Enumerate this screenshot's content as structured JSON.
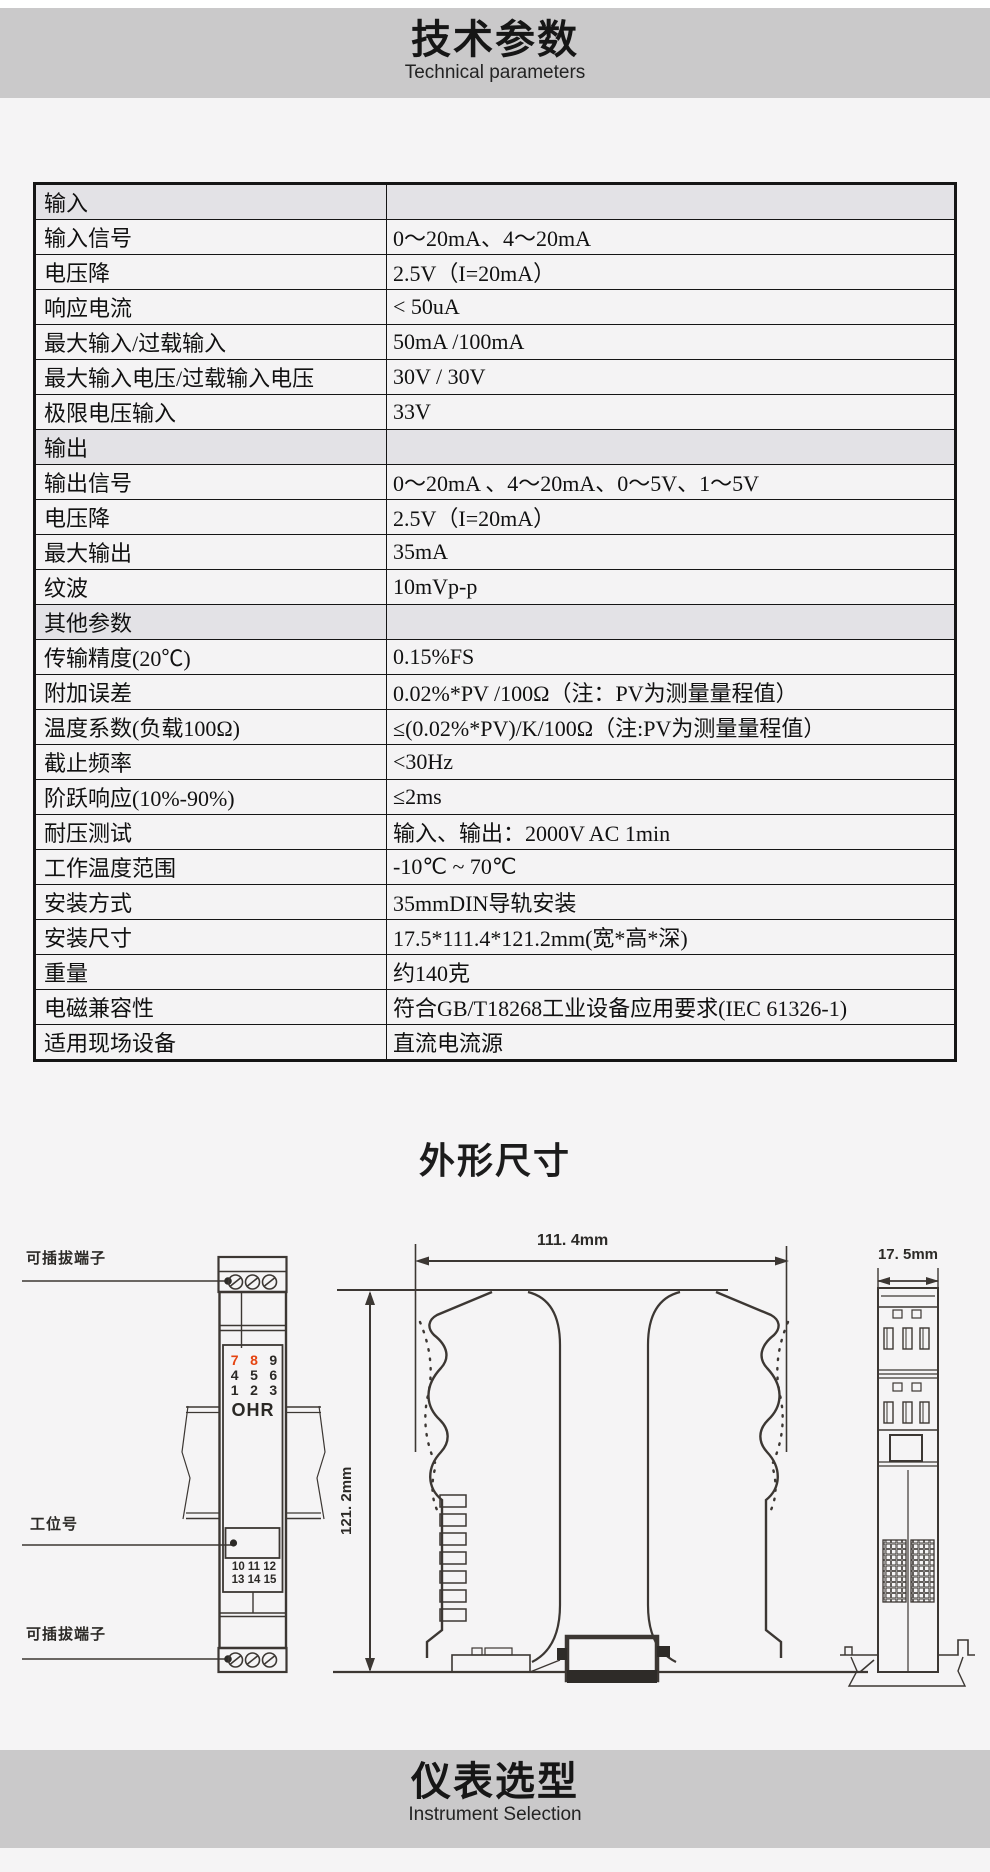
{
  "page": {
    "header": {
      "title_cn": "技术参数",
      "title_en": "Technical parameters"
    },
    "section2": {
      "title": "外形尺寸"
    },
    "footer": {
      "title_cn": "仪表选型",
      "title_en": "Instrument Selection"
    }
  },
  "colors": {
    "band_bg": "#cac9ca",
    "section_row_bg": "#e3e2e6",
    "terminal_red": "#e54310",
    "line_color": "#3c3733"
  },
  "table": {
    "rows": [
      {
        "type": "section",
        "name": "输入",
        "value": ""
      },
      {
        "type": "data",
        "name": "输入信号",
        "value": "0～20mA、4～20mA"
      },
      {
        "type": "data",
        "name": "电压降",
        "value": "2.5V（I=20mA）"
      },
      {
        "type": "data",
        "name": "响应电流",
        "value": "< 50uA"
      },
      {
        "type": "data",
        "name": "最大输入/过载输入",
        "value": "50mA /100mA"
      },
      {
        "type": "data",
        "name": "最大输入电压/过载输入电压",
        "value": "30V / 30V"
      },
      {
        "type": "data",
        "name": "极限电压输入",
        "value": "33V"
      },
      {
        "type": "section",
        "name": "输出",
        "value": ""
      },
      {
        "type": "data",
        "name": "输出信号",
        "value": "0～20mA 、4～20mA、0～5V、1～5V"
      },
      {
        "type": "data",
        "name": "电压降",
        "value": "2.5V（I=20mA）"
      },
      {
        "type": "data",
        "name": "最大输出",
        "value": "35mA"
      },
      {
        "type": "data",
        "name": "纹波",
        "value": "10mVp-p"
      },
      {
        "type": "section",
        "name": "其他参数",
        "value": ""
      },
      {
        "type": "data",
        "name": "传输精度(20℃)",
        "value": "0.15%FS"
      },
      {
        "type": "data",
        "name": "附加误差",
        "value": "0.02%*PV /100Ω（注：PV为测量量程值）"
      },
      {
        "type": "data",
        "name": "温度系数(负载100Ω)",
        "value": "≤(0.02%*PV)/K/100Ω（注:PV为测量量程值）"
      },
      {
        "type": "data",
        "name": "截止频率",
        "value": "<30Hz"
      },
      {
        "type": "data",
        "name": "阶跃响应(10%-90%)",
        "value": "≤2ms"
      },
      {
        "type": "data",
        "name": "耐压测试",
        "value": "输入、输出：2000V AC  1min"
      },
      {
        "type": "data",
        "name": "工作温度范围",
        "value": "-10℃ ~ 70℃"
      },
      {
        "type": "data",
        "name": "安装方式",
        "value": "35mmDIN导轨安装"
      },
      {
        "type": "data",
        "name": "安装尺寸",
        "value": "17.5*111.4*121.2mm(宽*高*深)"
      },
      {
        "type": "data",
        "name": "重量",
        "value": "约140克"
      },
      {
        "type": "data",
        "name": "电磁兼容性",
        "value": "符合GB/T18268工业设备应用要求(IEC 61326-1)"
      },
      {
        "type": "data",
        "name": "适用现场设备",
        "value": "直流电流源"
      }
    ]
  },
  "diagram": {
    "labels": {
      "pluggable_terminal_top": "可插拔端子",
      "station_no": "工位号",
      "pluggable_terminal_bottom": "可插拔端子",
      "brand": "OHR",
      "dim_width": "111. 4mm",
      "dim_depth": "121. 2mm",
      "dim_thickness": "17. 5mm"
    },
    "front_view": {
      "top_terminals": [
        [
          "7",
          "8",
          "9"
        ],
        [
          "4",
          "5",
          "6"
        ],
        [
          "1",
          "2",
          "3"
        ]
      ],
      "red_numbers": [
        "7",
        "8"
      ],
      "bottom_terminals": [
        "10 11 12",
        "13 14 15"
      ]
    }
  }
}
